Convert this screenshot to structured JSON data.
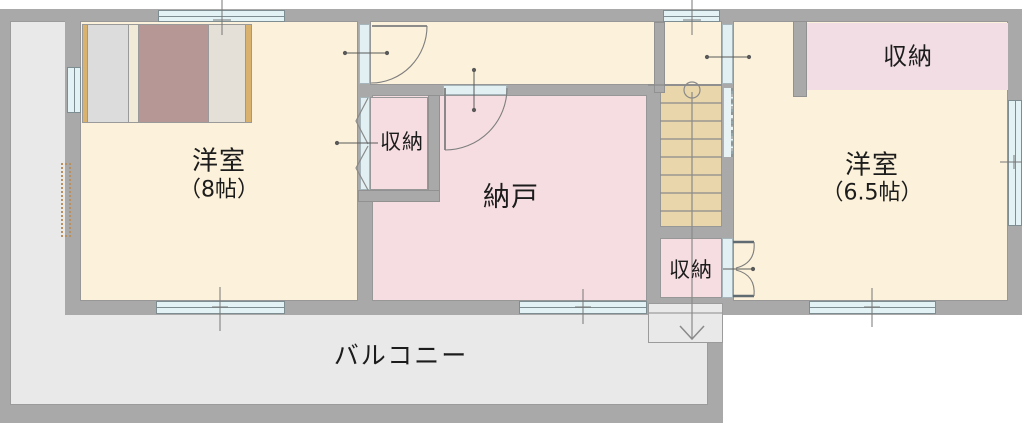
{
  "floorplan": {
    "title": "2F floor plan",
    "rooms": {
      "bedroom_left": {
        "label": "洋室",
        "size": "（8帖）"
      },
      "closet_left": {
        "label": "収納"
      },
      "storeroom": {
        "label": "納戸"
      },
      "closet_under_stairs": {
        "label": "収納"
      },
      "bedroom_right": {
        "label": "洋室",
        "size": "（6.5帖）"
      },
      "closet_right": {
        "label": "収納"
      },
      "balcony": {
        "label": "バルコニー"
      }
    },
    "colors": {
      "wall": "#a9a9a9",
      "room_floor": "#fcf1da",
      "storage_floor": "#f5dde1",
      "stairs_floor": "#ead6ab",
      "balcony_floor": "#e9e9e9",
      "window": "#e3f2f5",
      "bed_blanket": "#b69795",
      "bed_frame_trim": "#d9b26e"
    }
  }
}
